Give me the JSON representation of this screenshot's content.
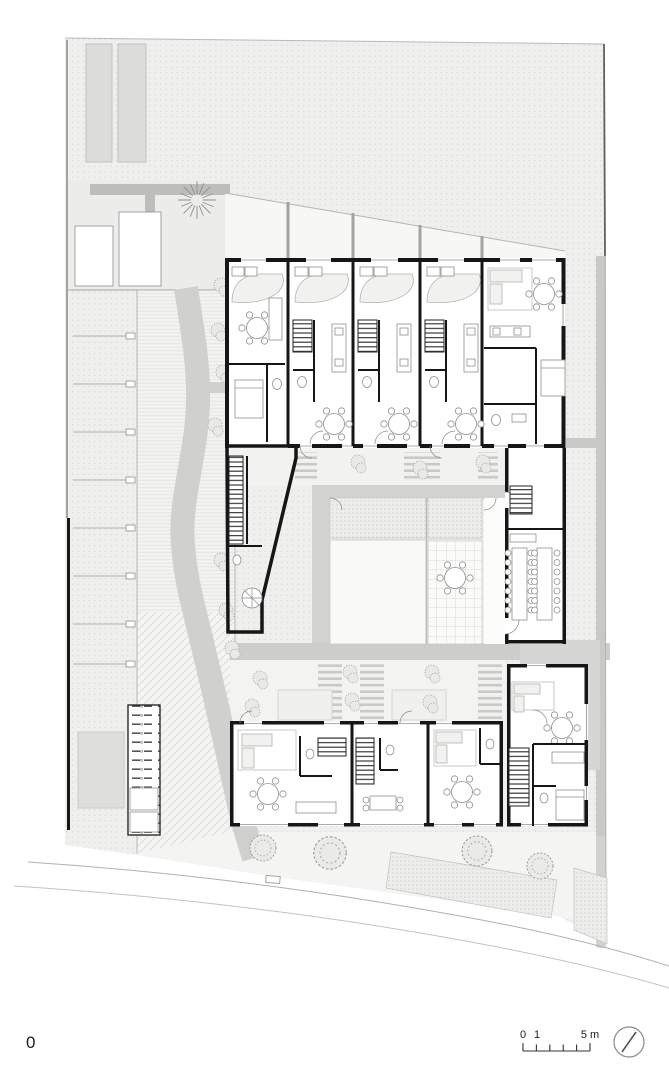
{
  "document": {
    "drawing_type": "architectural ground floor / site plan",
    "level_label": "0"
  },
  "scale_bar": {
    "tick_labels": [
      "0",
      "1",
      "5 m"
    ],
    "units": "m",
    "icon": "scale-bar"
  },
  "north_indicator": {
    "icon": "north-circle-icon"
  },
  "colors": {
    "paper": "#ffffff",
    "wall_black": "#161616",
    "site_stipple": "#efefee",
    "stipple_dot": "#d4d4d2",
    "path_gray": "#d0d0cf",
    "band_gray": "#cdcdcc",
    "neighbor_building_gray": "#dcdcdb",
    "garden_light": "#f7f7f6",
    "furniture_light": "#f1f1f0",
    "thin_line_gray": "#8f8f8d"
  }
}
